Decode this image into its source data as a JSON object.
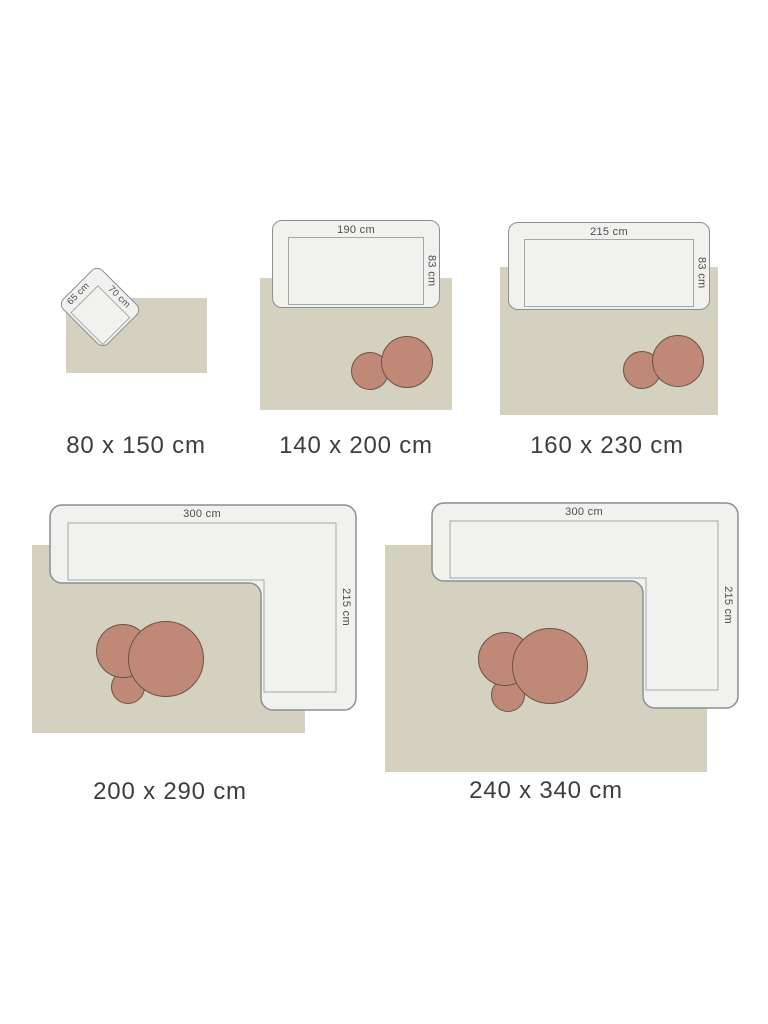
{
  "colors": {
    "rug": "#d4d1c0",
    "sofa_fill": "#f1f1ef",
    "sofa_border": "#8e8e8e",
    "inner_line": "#a6a6a6",
    "dim_text": "#4e4e4e",
    "circle_fill": "#c08977",
    "circle_border": "#6b5247",
    "caption_text": "#3d3d3d"
  },
  "diagrams": [
    {
      "caption": "80 x 150 cm",
      "furniture": {
        "type": "armchair",
        "width_label": "65 cm",
        "depth_label": "70 cm"
      },
      "tables_count": 0
    },
    {
      "caption": "140 x 200 cm",
      "furniture": {
        "type": "sofa",
        "width_label": "190 cm",
        "depth_label": "83 cm"
      },
      "tables_count": 2
    },
    {
      "caption": "160 x 230 cm",
      "furniture": {
        "type": "sofa",
        "width_label": "215 cm",
        "depth_label": "83 cm"
      },
      "tables_count": 2
    },
    {
      "caption": "200 x 290 cm",
      "furniture": {
        "type": "corner-sofa",
        "width_label": "300 cm",
        "depth_label": "215 cm"
      },
      "tables_count": 3
    },
    {
      "caption": "240 x 340 cm",
      "furniture": {
        "type": "corner-sofa",
        "width_label": "300 cm",
        "depth_label": "215 cm"
      },
      "tables_count": 3
    }
  ]
}
